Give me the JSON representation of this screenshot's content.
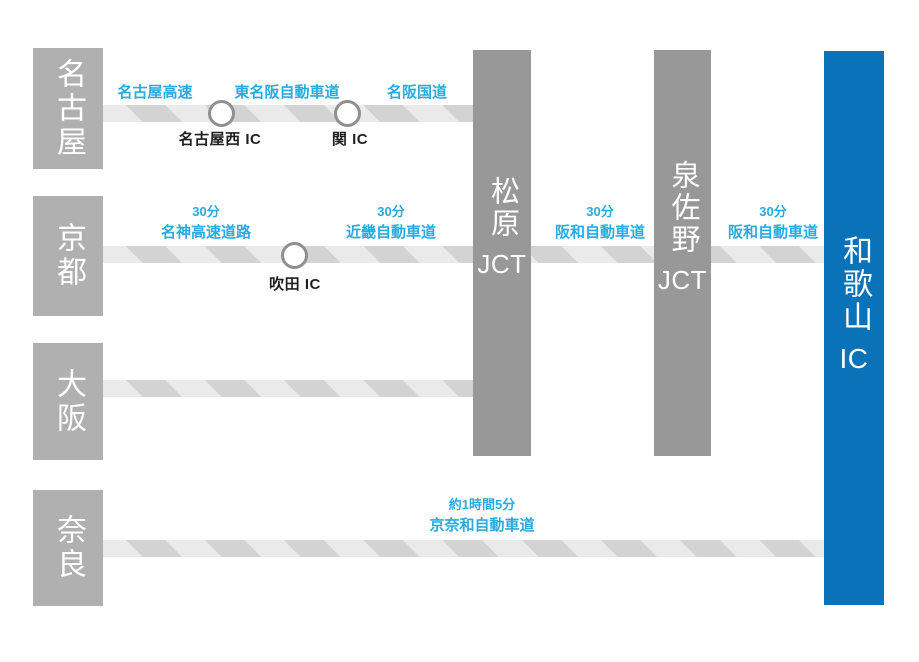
{
  "colors": {
    "destination_blue": "#0a72b9",
    "junction_gray": "#989898",
    "city_gray": "#b0b0b0",
    "label_blue": "#29abe2",
    "road_light": "#eaeaea",
    "road_dark": "#d3d3d3"
  },
  "cities": [
    {
      "name": "名古屋"
    },
    {
      "name": "京都"
    },
    {
      "name": "大阪"
    },
    {
      "name": "奈良"
    }
  ],
  "junctions": [
    {
      "name": "松原",
      "suffix": "JCT"
    },
    {
      "name": "泉佐野",
      "suffix": "JCT"
    }
  ],
  "destination": {
    "name": "和歌山",
    "suffix": "IC"
  },
  "routes": {
    "nagoya": {
      "roads": [
        "名古屋高速",
        "東名阪自動車道",
        "名阪国道"
      ],
      "ics": [
        "名古屋西 IC",
        "関 IC"
      ]
    },
    "kyoto": {
      "leg1": {
        "time": "30分",
        "road": "名神高速道路"
      },
      "leg2": {
        "time": "30分",
        "road": "近畿自動車道"
      },
      "ics": [
        "吹田 IC"
      ]
    },
    "matsubara_to_izumisano": {
      "time": "30分",
      "road": "阪和自動車道"
    },
    "izumisano_to_wakayama": {
      "time": "30分",
      "road": "阪和自動車道"
    },
    "nara": {
      "time": "約1時間5分",
      "road": "京奈和自動車道"
    }
  }
}
